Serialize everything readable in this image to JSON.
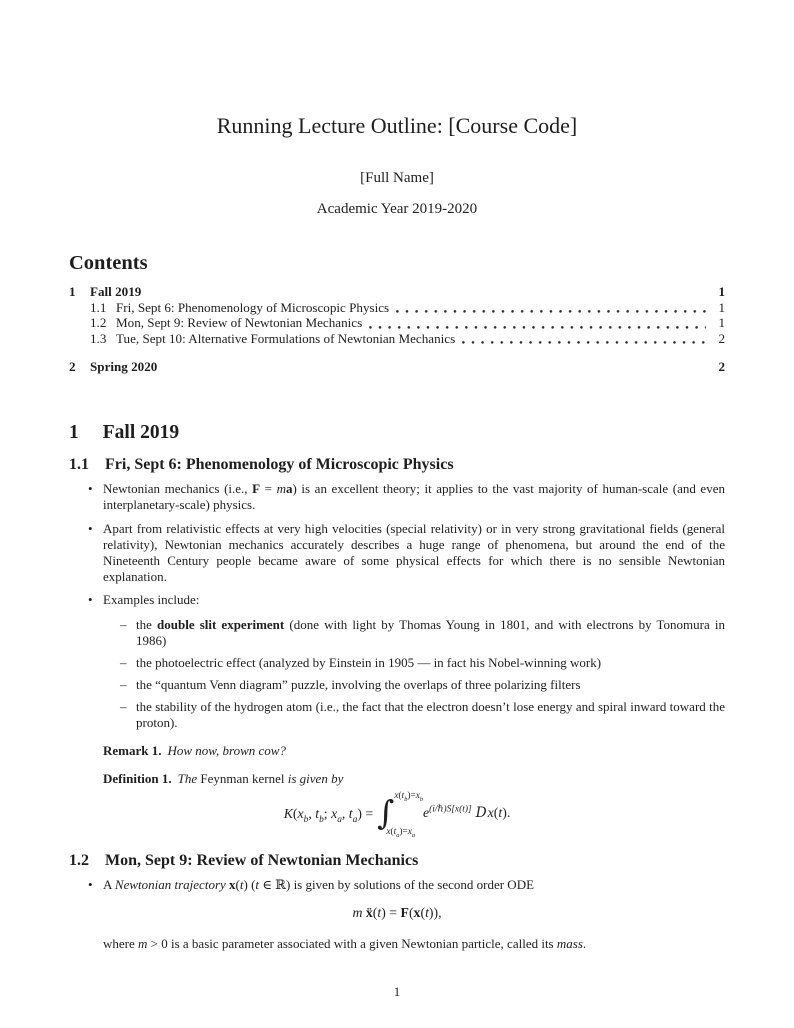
{
  "page": {
    "number": "1",
    "bullet_char": "•",
    "dash_char": "–"
  },
  "header": {
    "title": "Running Lecture Outline: [Course Code]",
    "author": "[Full Name]",
    "date": "Academic Year 2019-2020"
  },
  "toc": {
    "heading": "Contents",
    "entries": [
      {
        "num": "1",
        "title": "Fall 2019",
        "page": "1"
      },
      {
        "num": "1.1",
        "title": "Fri, Sept 6: Phenomenology of Microscopic Physics",
        "page": "1"
      },
      {
        "num": "1.2",
        "title": "Mon, Sept 9: Review of Newtonian Mechanics",
        "page": "1"
      },
      {
        "num": "1.3",
        "title": "Tue, Sept 10: Alternative Formulations of Newtonian Mechanics",
        "page": "2"
      },
      {
        "num": "2",
        "title": "Spring 2020",
        "page": "2"
      }
    ]
  },
  "sections": {
    "fall": {
      "num": "1",
      "title": "Fall 2019"
    },
    "s11": {
      "num": "1.1",
      "title": "Fri, Sept 6: Phenomenology of Microscopic Physics",
      "bullet1": [
        {
          "t": "Newtonian mechanics (i.e., "
        },
        {
          "t": "F",
          "s": "b"
        },
        {
          "t": " = "
        },
        {
          "t": "m",
          "s": "i"
        },
        {
          "t": "a",
          "s": "b"
        },
        {
          "t": ") is an excellent theory; it applies to the vast majority of human-scale (and even interplanetary-scale) physics."
        }
      ],
      "bullet2": [
        {
          "t": "Apart from relativistic effects at very high velocities (special relativity) or in very strong gravitational fields (general relativity), Newtonian mechanics accurately describes a huge range of phenomena, but around the end of the Nineteenth Century people became aware of some physical effects for which there is no sensible Newtonian explanation."
        }
      ],
      "bullet3": [
        {
          "t": "Examples include:"
        }
      ],
      "examples": [
        [
          {
            "t": "the "
          },
          {
            "t": "double slit experiment",
            "s": "b"
          },
          {
            "t": " (done with light by Thomas Young in 1801, and with electrons by Tonomura in 1986)"
          }
        ],
        [
          {
            "t": "the photoelectric effect (analyzed by Einstein in 1905 — in fact his Nobel-winning work)"
          }
        ],
        [
          {
            "t": "the “quantum Venn diagram” puzzle, involving the overlaps of three polarizing filters"
          }
        ],
        [
          {
            "t": "the stability of the hydrogen atom (i.e., the fact that the electron doesn’t lose energy and spiral inward toward the proton)."
          }
        ]
      ],
      "remark_label": "Remark 1.",
      "remark_text": "How now, brown cow?",
      "definition_label": "Definition 1.",
      "definition_parts": [
        {
          "t": "The ",
          "s": "i"
        },
        {
          "t": "Feynman kernel"
        },
        {
          "t": " is given by",
          "s": "i"
        }
      ],
      "int_sign": "∫",
      "kernel_lhs": [
        {
          "t": "K",
          "s": "i"
        },
        {
          "t": "("
        },
        {
          "t": "x",
          "s": "i"
        },
        {
          "t": "b",
          "s": "sub i"
        },
        {
          "t": ", "
        },
        {
          "t": "t",
          "s": "i"
        },
        {
          "t": "b",
          "s": "sub i"
        },
        {
          "t": "; "
        },
        {
          "t": "x",
          "s": "i"
        },
        {
          "t": "a",
          "s": "sub i"
        },
        {
          "t": ", "
        },
        {
          "t": "t",
          "s": "i"
        },
        {
          "t": "a",
          "s": "sub i"
        },
        {
          "t": ") = "
        }
      ],
      "kernel_upper": [
        {
          "t": "x",
          "s": "i"
        },
        {
          "t": "("
        },
        {
          "t": "t",
          "s": "i"
        },
        {
          "t": "b",
          "s": "sub i"
        },
        {
          "t": ")="
        },
        {
          "t": "x",
          "s": "i"
        },
        {
          "t": "b",
          "s": "sub i"
        }
      ],
      "kernel_lower": [
        {
          "t": "x",
          "s": "i"
        },
        {
          "t": "("
        },
        {
          "t": "t",
          "s": "i"
        },
        {
          "t": "a",
          "s": "sub i"
        },
        {
          "t": ")="
        },
        {
          "t": "x",
          "s": "i"
        },
        {
          "t": "a",
          "s": "sub i"
        }
      ],
      "kernel_rhs": [
        {
          "t": "e",
          "s": "i"
        },
        {
          "t": "(i/ℏ)S[x(t)]",
          "s": "sup i"
        },
        {
          "t": "D",
          "s": "scriptD"
        },
        {
          "t": "x",
          "s": "i"
        },
        {
          "t": "("
        },
        {
          "t": "t",
          "s": "i"
        },
        {
          "t": ")."
        }
      ]
    },
    "s12": {
      "num": "1.2",
      "title": "Mon, Sept 9: Review of Newtonian Mechanics",
      "bullet1": [
        {
          "t": "A "
        },
        {
          "t": "Newtonian trajectory",
          "s": "i"
        },
        {
          "t": " "
        },
        {
          "t": "x",
          "s": "b"
        },
        {
          "t": "("
        },
        {
          "t": "t",
          "s": "i"
        },
        {
          "t": ") ("
        },
        {
          "t": "t",
          "s": "i"
        },
        {
          "t": " ∈ ℝ"
        },
        {
          "t": ") is given by solutions of the second order ODE"
        }
      ],
      "ode": [
        {
          "t": "m",
          "s": "i"
        },
        {
          "t": " "
        },
        {
          "t": "ẍ",
          "s": "b"
        },
        {
          "t": "("
        },
        {
          "t": "t",
          "s": "i"
        },
        {
          "t": ") = "
        },
        {
          "t": "F",
          "s": "b"
        },
        {
          "t": "("
        },
        {
          "t": "x",
          "s": "b"
        },
        {
          "t": "("
        },
        {
          "t": "t",
          "s": "i"
        },
        {
          "t": ")),"
        }
      ],
      "after": [
        {
          "t": "where "
        },
        {
          "t": "m",
          "s": "i"
        },
        {
          "t": " > 0 is a basic parameter associated with a given Newtonian particle, called its "
        },
        {
          "t": "mass",
          "s": "i"
        },
        {
          "t": "."
        }
      ]
    }
  }
}
